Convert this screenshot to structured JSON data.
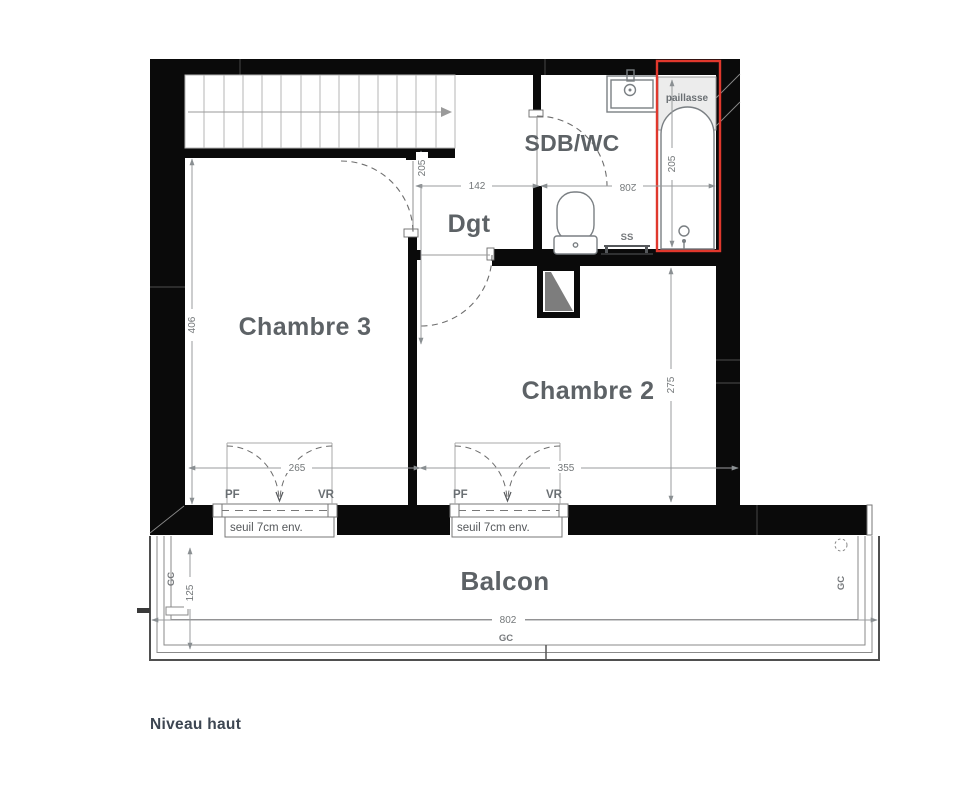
{
  "page": {
    "background": "#ffffff",
    "footer_label": "Niveau haut"
  },
  "colors": {
    "wall_black": "#0a0a0a",
    "tub_highlight_red": "#e0382d",
    "room_label_gray": "#5d6266",
    "dimension_gray": "#737779"
  },
  "rooms": {
    "chambre3": {
      "label": "Chambre 3"
    },
    "chambre2": {
      "label": "Chambre 2"
    },
    "sdb_wc": {
      "label": "SDB/WC"
    },
    "degagement": {
      "label": "Dgt"
    },
    "balcon": {
      "label": "Balcon"
    }
  },
  "fixtures": {
    "paillasse_label": "paillasse",
    "towel_rail_label": "SS"
  },
  "windows": {
    "window1": {
      "left_label": "PF",
      "right_label": "VR",
      "sill_label": "seuil 7cm env.",
      "width_dim": "265"
    },
    "window2": {
      "left_label": "PF",
      "right_label": "VR",
      "sill_label": "seuil 7cm env.",
      "width_dim": "355"
    }
  },
  "dimensions": {
    "dgt_width": "142",
    "sdb_width": "208",
    "dgt_length": "205",
    "bath_length": "205",
    "chambre3_depth": "406",
    "chambre2_depth": "275",
    "balcony_depth": "125",
    "balcony_width": "802"
  },
  "gutter_labels": {
    "left": "GC",
    "right": "GC",
    "bottom": "GC"
  }
}
